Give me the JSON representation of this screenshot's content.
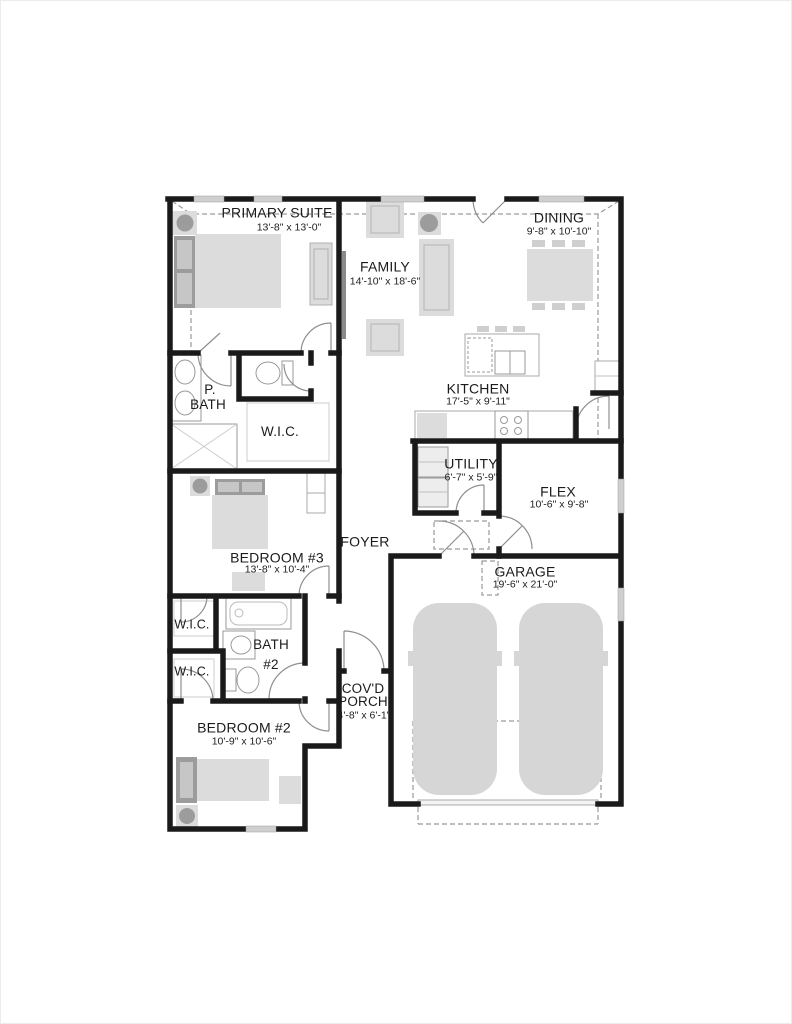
{
  "plan": {
    "type": "floor-plan",
    "rooms": {
      "primary_suite": {
        "name": "PRIMARY SUITE",
        "dims": "13'-8\" x 13'-0\""
      },
      "family": {
        "name": "FAMILY",
        "dims": "14'-10\" x 18'-6\""
      },
      "dining": {
        "name": "DINING",
        "dims": "9'-8\" x 10'-10\""
      },
      "kitchen": {
        "name": "KITCHEN",
        "dims": "17'-5\" x 9'-11\""
      },
      "utility": {
        "name": "UTILITY",
        "dims": "6'-7\" x 5'-9\""
      },
      "flex": {
        "name": "FLEX",
        "dims": "10'-6\" x 9'-8\""
      },
      "garage": {
        "name": "GARAGE",
        "dims": "19'-6\" x 21'-0\""
      },
      "foyer": {
        "name": "FOYER"
      },
      "bedroom_3": {
        "name": "BEDROOM #3",
        "dims": "13'-8\" x 10'-4\""
      },
      "bedroom_2": {
        "name": "BEDROOM #2",
        "dims": "10'-9\" x 10'-6\""
      },
      "primary_bath": {
        "line1": "P.",
        "line2": "BATH"
      },
      "bath_2": {
        "line1": "BATH",
        "line2": "#2"
      },
      "wic_primary": {
        "name": "W.I.C."
      },
      "wic_upper": {
        "name": "W.I.C."
      },
      "wic_lower": {
        "name": "W.I.C."
      },
      "covd_porch": {
        "line1": "COV'D",
        "line2": "PORCH",
        "dims": "4'-8\" x 6'-1\""
      }
    },
    "colors": {
      "wall": "#1a1a1a",
      "furniture_fill": "#dcdcdc",
      "furniture_dark": "#9c9c9c",
      "window": "#cfcfcf",
      "dashed_line": "#9a9a9a",
      "door_line": "#8f8f8f",
      "text": "#1b1b1b",
      "background": "#ffffff"
    }
  }
}
